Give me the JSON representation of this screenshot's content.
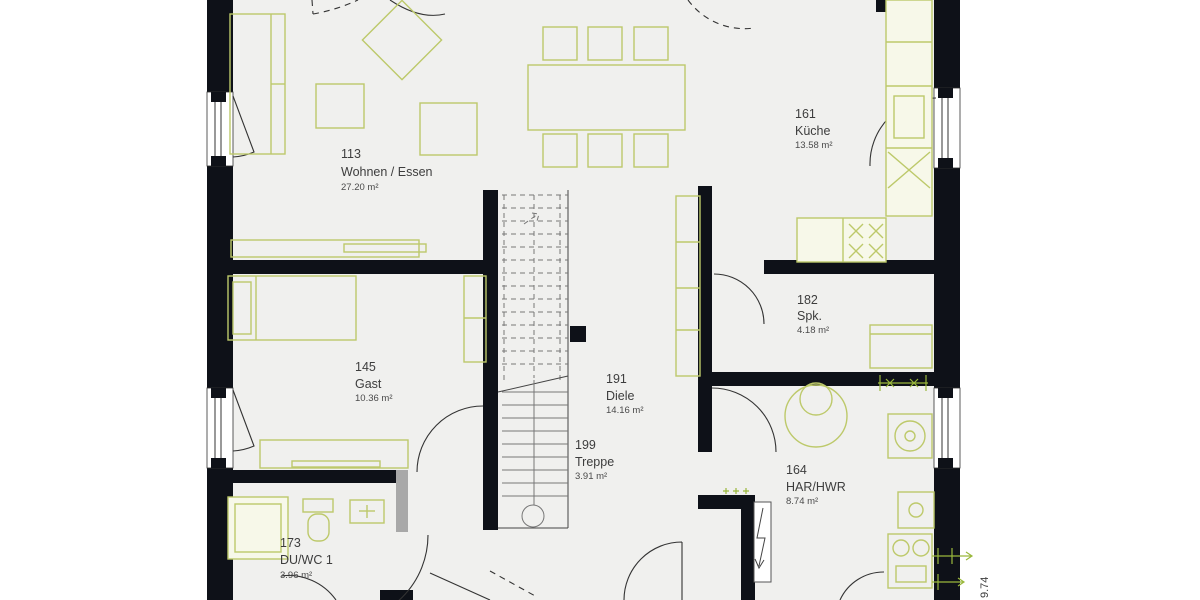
{
  "plan": {
    "title": "Grundriss Erdgeschoss",
    "rooms": [
      {
        "number": "113",
        "name": "Wohnen / Essen",
        "area": "27.20 m²"
      },
      {
        "number": "161",
        "name": "Küche",
        "area": "13.58 m²"
      },
      {
        "number": "182",
        "name": "Spk.",
        "area": "4.18 m²"
      },
      {
        "number": "145",
        "name": "Gast",
        "area": "10.36 m²"
      },
      {
        "number": "191",
        "name": "Diele",
        "area": "14.16 m²"
      },
      {
        "number": "199",
        "name": "Treppe",
        "area": "3.91 m²"
      },
      {
        "number": "164",
        "name": "HAR/HWR",
        "area": "8.74 m²"
      },
      {
        "number": "173",
        "name": "DU/WC 1",
        "area": "3.96 m²"
      }
    ],
    "dimensions": {
      "right_vertical": "9.74"
    },
    "colors": {
      "wall": "#0e1118",
      "floor": "#f0f0ee",
      "furniture_outline": "#bdc96a",
      "dimension_green": "#9ab83c",
      "door_line": "#333333",
      "label_text": "#3d3d3d"
    }
  }
}
